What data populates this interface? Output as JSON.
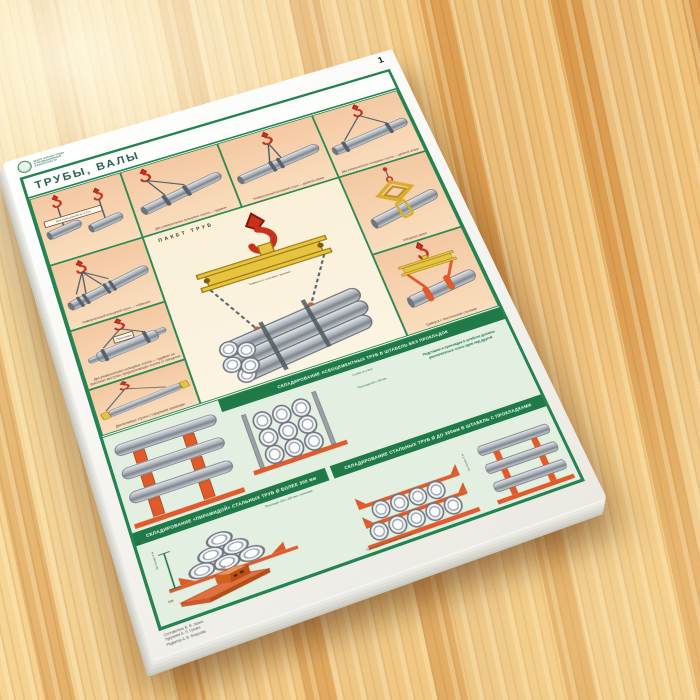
{
  "page_number": "1",
  "logo": {
    "line1": "ЦЕНТР ОХРАНЫ ТРУДА",
    "line2": "И ПРОМЫШЛЕННОЙ",
    "line3": "БЕЗОПАСНОСТИ"
  },
  "title": "ТРУБЫ, ВАЛЫ",
  "cells": {
    "c1_label": "Для труб длиной до 1,5 м",
    "c2_caption": "Два универсальных кольцевых стропа — «удавка»",
    "c3_caption": "Универсальный кольцевой строп — двойной обхват",
    "c4_caption": "Два универсальных кольцевых стропа — двойной обхват",
    "c5_caption": "Клещевой захват",
    "c6_caption": "Траверса с текстильными стропами",
    "c7_caption": "Универсальный кольцевой строп — «обвязка»",
    "c8_caption": "Два универсальных кольцевых стропа — «удавка» на фасонных выступах, предохраняющих стропы от смещения",
    "c8_label": "Прокладки",
    "c9_caption": "Два ветвевых стропа с торцевыми захватами",
    "center_title": "ПАКЕТ ТРУБ",
    "center_caption": "Траверса со стропами с крюками"
  },
  "storage": {
    "header_a": "СКЛАДИРОВАНИЕ АСБОЦЕМЕНТНЫХ ТРУБ В ШТАБЕЛЬ БЕЗ ПРОКЛАДОК",
    "a_label_post": "Стойки из стали",
    "a_label_spacer": "Прокладки 50 х 100 мм",
    "a_note": "Подставки и прокладки в штабеле должны располагаться точно одна над другой",
    "header_b": "СКЛАДИРОВАНИЕ «ПИРАМИДОЙ» СТАЛЬНЫХ ТРУБ Ø БОЛЕЕ 300 мм",
    "b_label_height": "Не более 3 м",
    "b_label_spacer": "Прокладки 100 х 200 мм с клиньями",
    "b_dim_length": "300",
    "b_dim_width": "150",
    "header_c": "СКЛАДИРОВАНИЕ СТАЛЬНЫХ ТРУБ Ø ДО 300мм В ШТАБЕЛЬ С ПРОКЛАДКАМИ",
    "c_label_spacer": "Прокладки 50 х 150 мм с клиньями",
    "c_label_height": "Не более 3 м"
  },
  "credits": {
    "line1": "Составитель В. Ф. Ланин",
    "line2": "Художник Б. П. Грозин",
    "line3": "Редактор А. В. Фокусова"
  },
  "colors": {
    "frame_green": "#258352",
    "peach": "#f6cfae",
    "cream": "#faf0da",
    "mint": "#e3f0e1",
    "orange": "#e05a2b",
    "yellow": "#e7c440",
    "hook_red": "#c8311c"
  }
}
